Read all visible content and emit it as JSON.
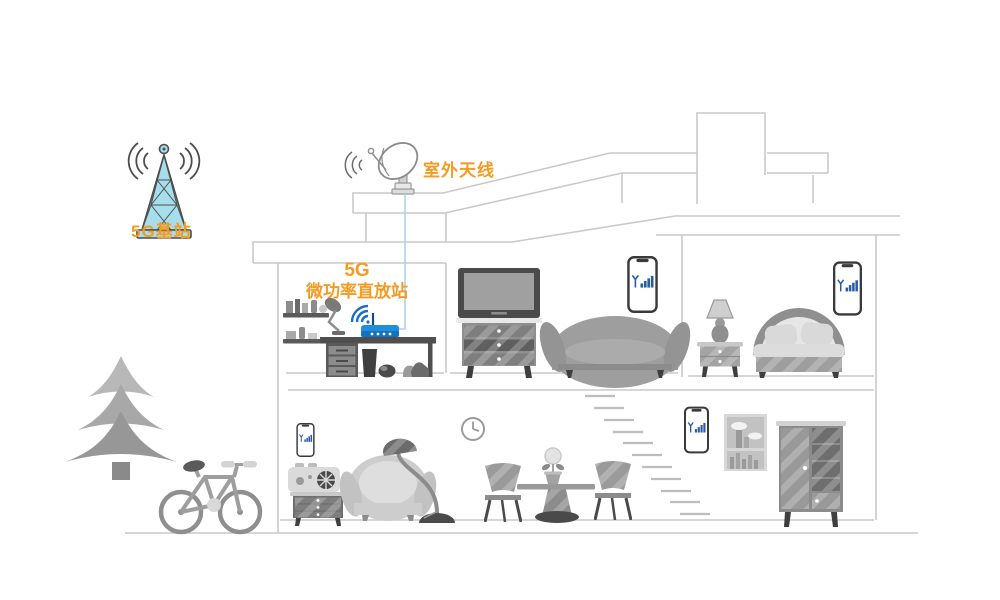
{
  "labels": {
    "base_station": "5G基站",
    "outdoor_antenna": "室外天线",
    "repeater_line1": "5G",
    "repeater_line2": "微功率直放站"
  },
  "colors": {
    "accent_orange": "#F59B23",
    "tower_fill": "#A6DEEB",
    "tower_stroke": "#4D4D4D",
    "router_blue": "#1F8FDC",
    "wifi_blue": "#1A6FC0",
    "phone_signal_blue": "#2A5DA8",
    "cable_blue": "#ADD2EC",
    "house_outline": "#C9C9C9",
    "furniture_gray": "#9A9A9A"
  },
  "icons": {
    "base_station": "cell-tower-icon",
    "base_station_waves": "radio-waves-icon",
    "outdoor_antenna": "satellite-dish-icon",
    "repeater": "wifi-router-icon",
    "repeater_waves": "wifi-waves-icon",
    "phone": "smartphone-signal-icon",
    "clock": "wall-clock-icon"
  },
  "phones": {
    "count": 4,
    "signal_bars_per_phone": 4
  }
}
